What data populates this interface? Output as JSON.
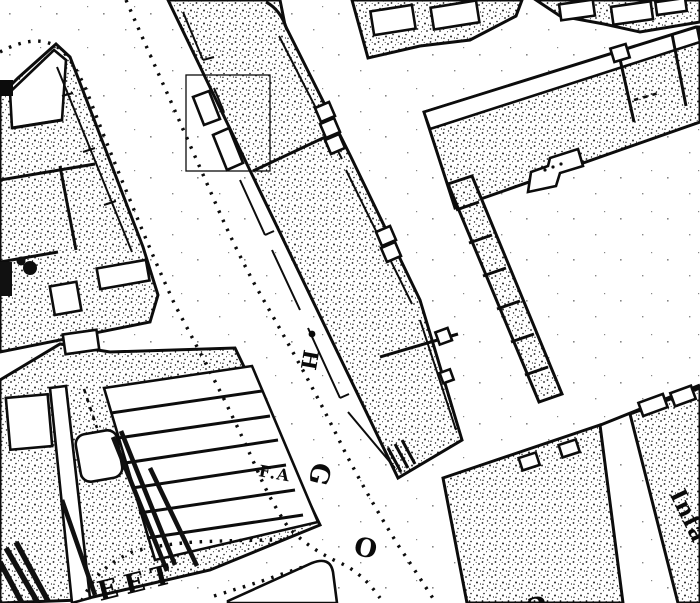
{
  "map": {
    "description": "historical town-plan map extract, black ink on white paper",
    "colors": {
      "ink": "#0c0c0c",
      "paper": "#ffffff"
    },
    "letters": {
      "h": "H",
      "fa": "F.A",
      "g": "G",
      "o": "O",
      "partial_bottom": "a"
    },
    "labels": {
      "street_fragment": "EET",
      "building_fragment": "Infa"
    },
    "annotations": {
      "highlight_box": "rectangle outline over buildings on west side of central block"
    }
  }
}
